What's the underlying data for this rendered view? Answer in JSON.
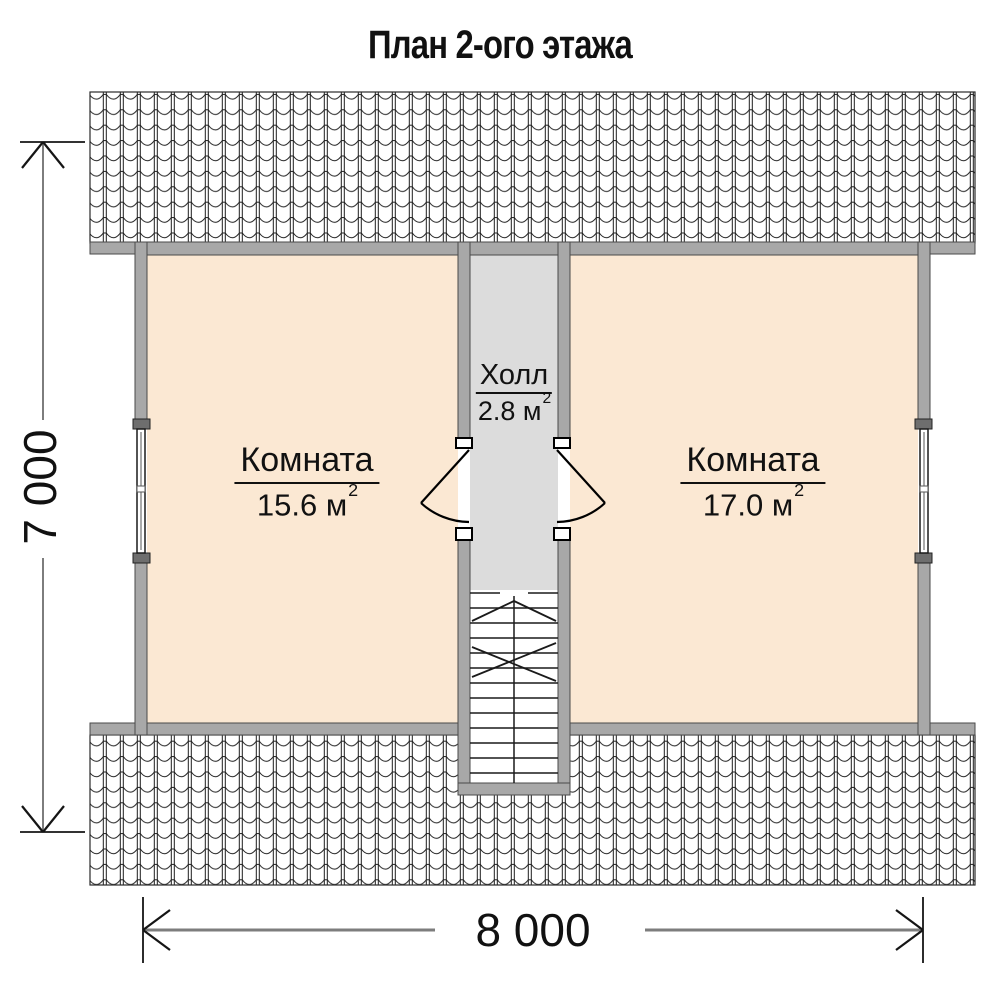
{
  "title": "План 2-ого этажа",
  "rooms": [
    {
      "name": "Комната",
      "area": "15.6 м",
      "sup": "2"
    },
    {
      "name": "Комната",
      "area": "17.0 м",
      "sup": "2"
    }
  ],
  "hall": {
    "name": "Холл",
    "area": "2.8 м",
    "sup": "2"
  },
  "dimensions": {
    "height": "7 000",
    "width": "8 000"
  },
  "icons": {
    "roof_pattern": "roof-tile-hatch",
    "door_symbols": "door-swing-arc",
    "window_symbols": "window-frame",
    "stair_symbol": "staircase-with-break-lines",
    "dimension_arrows": "open-arrowheads"
  },
  "colors": {
    "room_fill": "#fbe8d3",
    "hall_fill": "#dcdcdc",
    "stair_fill": "#ffffff",
    "wall_fill": "#a8a8a8",
    "wall_stroke": "#4a4a4a",
    "line": "#1a1a1a",
    "dim_line": "#7d7d7d",
    "text": "#111111"
  }
}
